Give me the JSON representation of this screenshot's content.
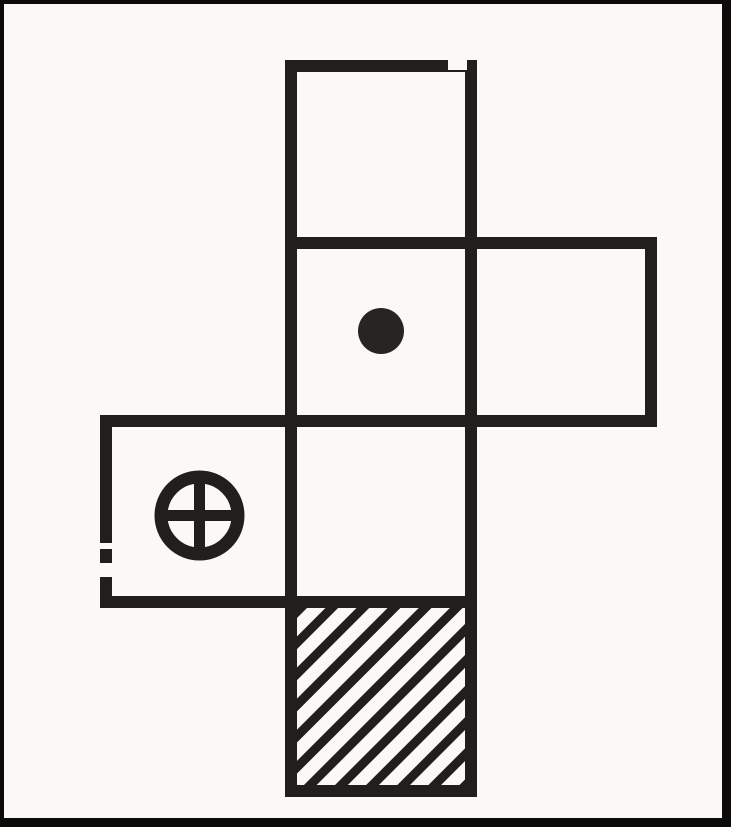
{
  "page": {
    "background": "#fbf9f6"
  },
  "figure": {
    "type": "cube-net-diagram",
    "description": "Scanned black-and-white figure of an unfolded cube (net of six squares): a vertical column of four squares, one square attached to the right of the second square, one square attached to the left of the third square. The second column square bears a solid dot, the left square bears a circled plus, the bottom square is filled with diagonal hatching; the other three faces are blank.",
    "background": "#fbf9f6",
    "line_color": "#221e1b",
    "stroke_width": 12,
    "canvas": {
      "width": 731,
      "height": 827
    },
    "frame": {
      "color": "#0d0b0a",
      "top": 4,
      "left": 4,
      "right": 9,
      "bottom": 9
    },
    "grid": {
      "cols_x": [
        106,
        291,
        471,
        651
      ],
      "rows_y": [
        66,
        243,
        421,
        602,
        791
      ]
    },
    "cells": [
      {
        "name": "face-top-blank",
        "col": 1,
        "row": 0,
        "symbol": "blank",
        "dx": 0,
        "dy": 0
      },
      {
        "name": "face-dot",
        "col": 1,
        "row": 1,
        "symbol": "dot",
        "dx": 0,
        "dy": -1
      },
      {
        "name": "face-right-blank",
        "col": 2,
        "row": 1,
        "symbol": "blank",
        "dx": 0,
        "dy": 0
      },
      {
        "name": "face-circled-plus",
        "col": 0,
        "row": 2,
        "symbol": "circled-plus",
        "dx": 1,
        "dy": 4
      },
      {
        "name": "face-middle-blank",
        "col": 1,
        "row": 2,
        "symbol": "blank",
        "dx": 0,
        "dy": 0
      },
      {
        "name": "face-hatched",
        "col": 1,
        "row": 3,
        "symbol": "hatch",
        "dx": 0,
        "dy": 0
      }
    ],
    "symbols": {
      "dot": {
        "radius": 23,
        "fill": "#282423"
      },
      "circled_plus": {
        "outer_radius": 45,
        "ring_stroke": 13,
        "cross_stroke": 11
      },
      "hatch": {
        "period": 22,
        "stripe": 9,
        "angle_deg": -45
      }
    },
    "artifacts": [
      {
        "x": 448,
        "y": 57,
        "w": 19,
        "h": 13
      },
      {
        "x": 99,
        "y": 563,
        "w": 14,
        "h": 14
      },
      {
        "x": 100,
        "y": 543,
        "w": 12,
        "h": 6
      }
    ]
  }
}
